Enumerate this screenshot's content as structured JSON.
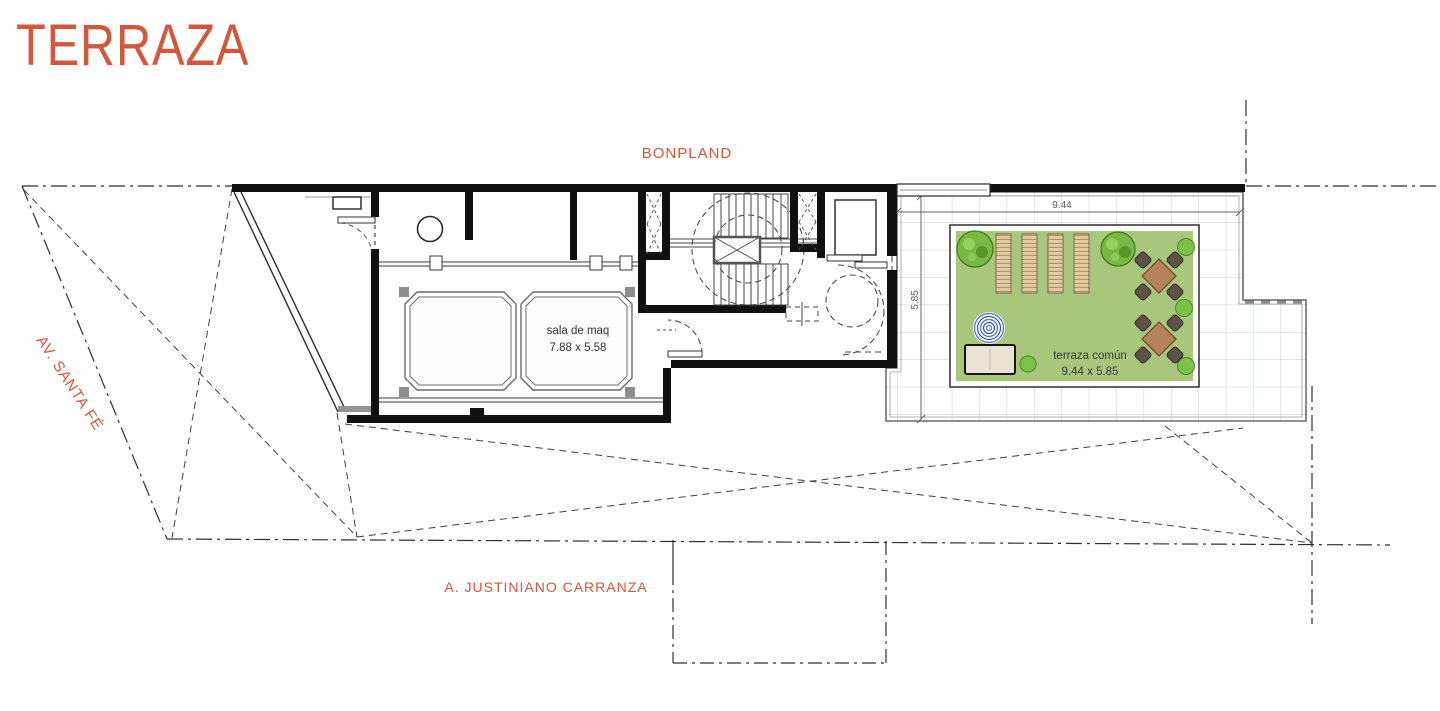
{
  "page": {
    "title": "TERRAZA"
  },
  "streets": {
    "top": "BONPLAND",
    "left": "AV. SANTA FÉ",
    "bottom": "A. JUSTINIANO CARRANZA"
  },
  "plan": {
    "machine_room": {
      "name": "sala de maq",
      "size": "7.88 x 5.58"
    },
    "terrace": {
      "name": "terraza común",
      "size": "9.44 x 5.85"
    },
    "dim_width": "9.44",
    "dim_height": "5.85"
  },
  "colors": {
    "accent": "#d0583c",
    "wall": "#111111",
    "rug_green": "#a8c77d",
    "tree_green": "#79b844",
    "lounger_wood": "#e3cba0",
    "table_brown": "#b5835a",
    "chair_dark": "#5d5447",
    "spa_blue": "#5b80c4",
    "dim_gray": "#5a5a5a"
  }
}
